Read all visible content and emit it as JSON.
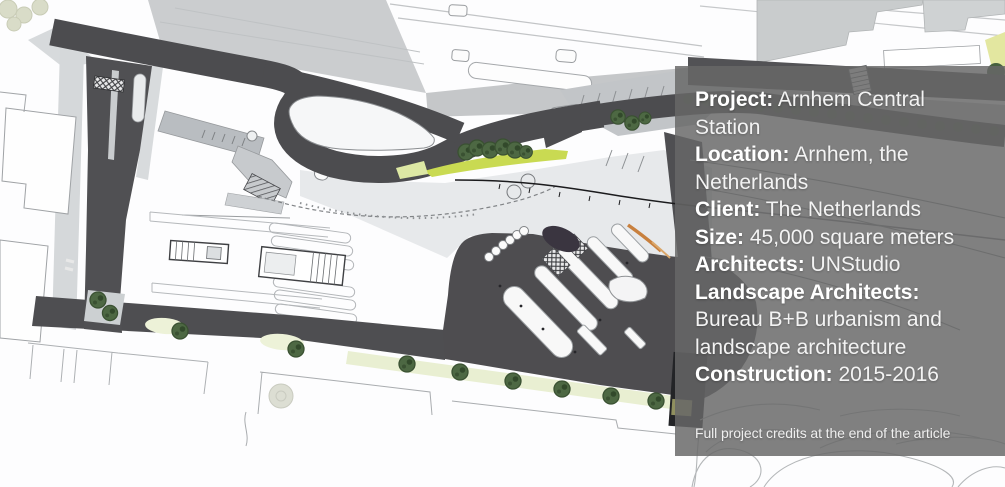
{
  "overlay": {
    "fields": [
      {
        "label": "Project:",
        "value": "Arnhem Central Station"
      },
      {
        "label": "Location:",
        "value": "Arnhem, the Netherlands"
      },
      {
        "label": "Client:",
        "value": "The Netherlands"
      },
      {
        "label": "Size:",
        "value": "45,000 square meters"
      },
      {
        "label": "Architects:",
        "value": "UNStudio"
      },
      {
        "label": "Landscape Architects:",
        "value": "Bureau B+B urbanism and landscape architecture"
      },
      {
        "label": "Construction:",
        "value": "2015-2016"
      }
    ],
    "footnote": "Full project credits at the end of the article",
    "background_color": "#686868",
    "text_color": "#f3f3f3"
  },
  "plan": {
    "name": "Arnhem Central Station master plan drawing",
    "colors": {
      "road_asphalt": "#4c4c4f",
      "railway_deck": "#cbcdcf",
      "canopy_gray": "#b9bdc1",
      "plaza": "#e7e9eb",
      "planting_bright": "#c9da52",
      "planting_pale": "#e9efd2",
      "tree_green": "#4d6843",
      "accent_orange": "#c8803e",
      "black_building": "#232427"
    }
  }
}
